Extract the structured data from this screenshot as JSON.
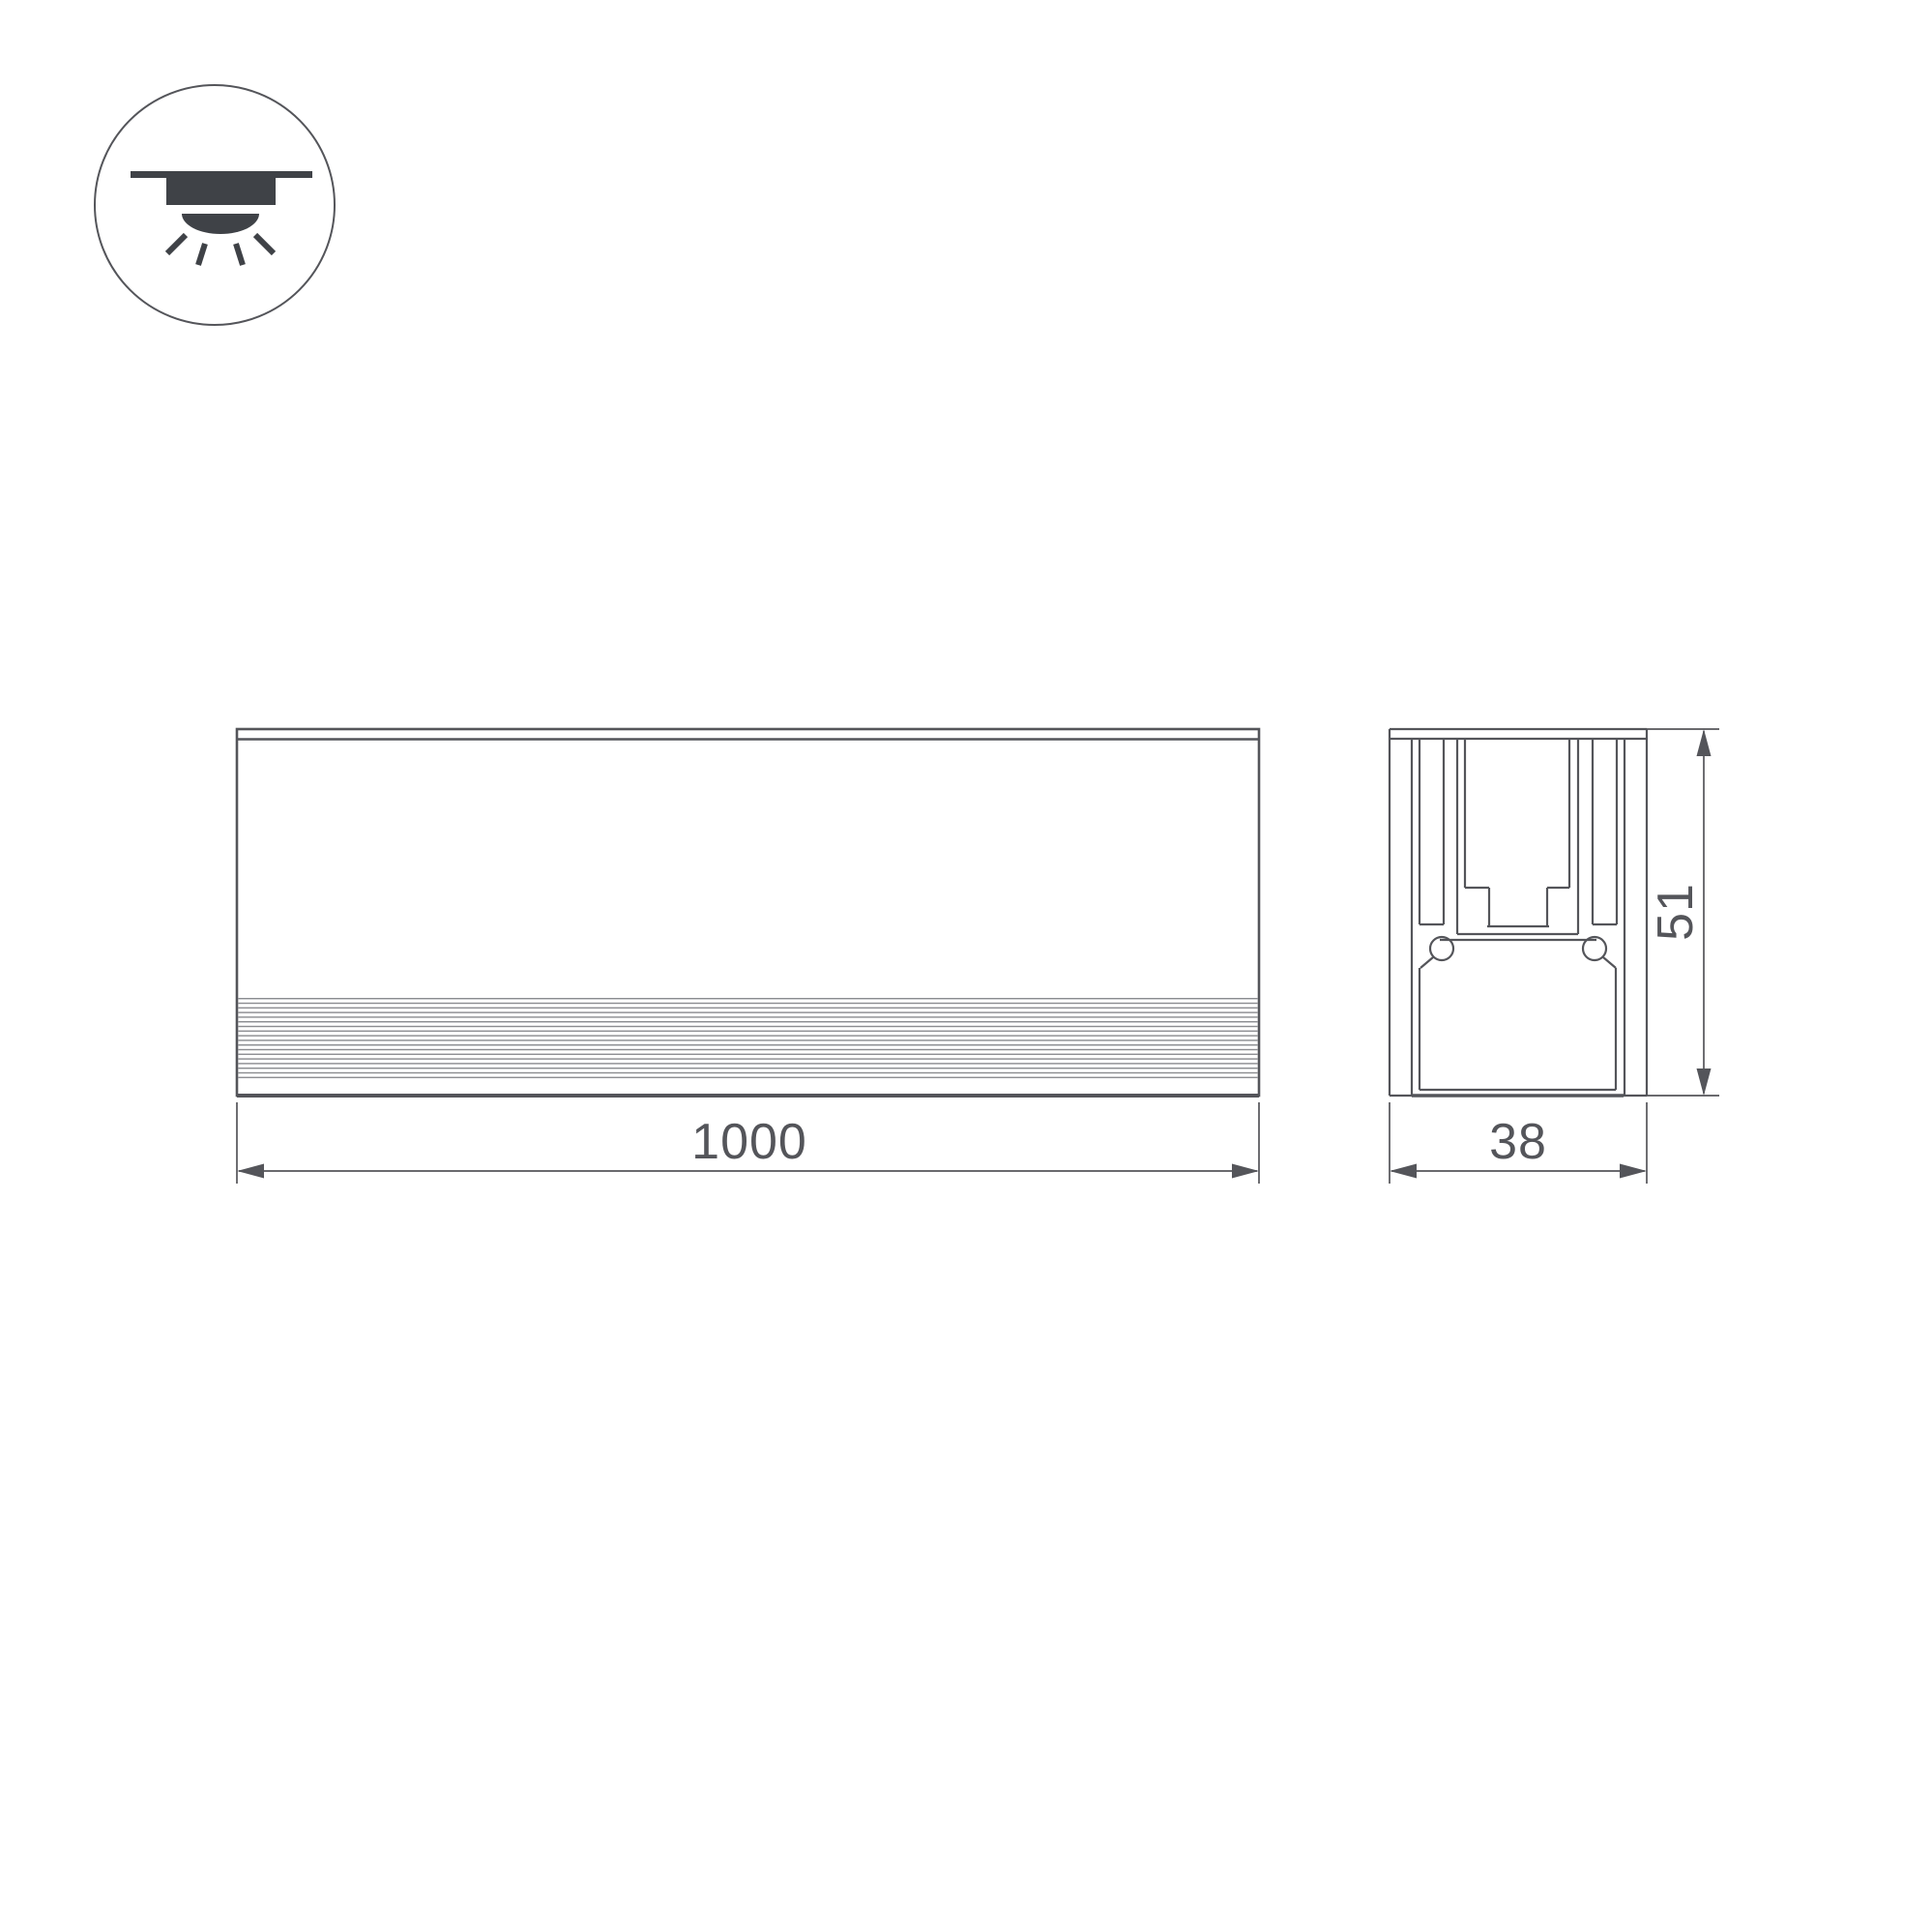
{
  "drawing": {
    "background": "#ffffff",
    "line_color": "#54555A",
    "thin_line_color": "#8A8B8F",
    "icon_color": "#3F4247",
    "icon": {
      "name": "recessed-downlight",
      "meaning": "recessed ceiling mount luminaire"
    },
    "views": {
      "front": {
        "dimension_length": "1000"
      },
      "section": {
        "dimension_width": "38",
        "dimension_height": "51"
      }
    }
  }
}
